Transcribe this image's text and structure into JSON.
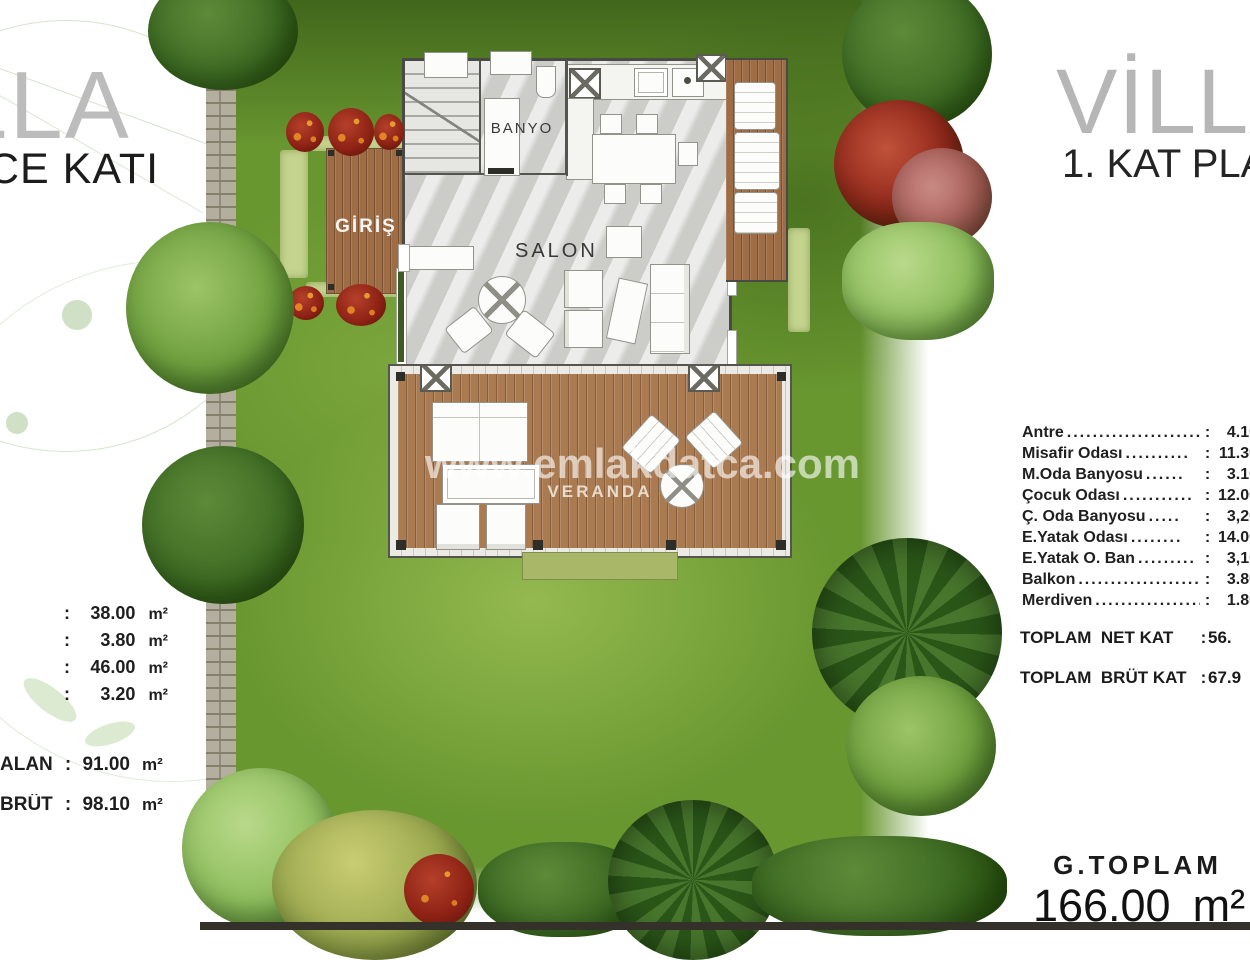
{
  "watermark": {
    "text": "www.emlakdatca.com"
  },
  "left_panel": {
    "title_partial": "LLA",
    "subtitle_partial": "CE KATI",
    "sep": ":",
    "measurements": [
      {
        "value": "38.00",
        "unit": "m²"
      },
      {
        "value": "3.80",
        "unit": "m²"
      },
      {
        "value": "46.00",
        "unit": "m²"
      },
      {
        "value": "3.20",
        "unit": "m²"
      }
    ],
    "totals": [
      {
        "label": "ALAN",
        "value": "91.00",
        "unit": "m²"
      },
      {
        "label": "BRÜT",
        "value": "98.10",
        "unit": "m²"
      }
    ]
  },
  "right_panel": {
    "title": "VİLLA",
    "subtitle": "1. KAT PLANI",
    "sep": ":",
    "rooms": [
      {
        "name": "Antre",
        "dots": "......................",
        "value": "4.10"
      },
      {
        "name": "Misafir Odası",
        "dots": "..........",
        "value": "11.30"
      },
      {
        "name": "M.Oda Banyosu",
        "dots": "......",
        "value": "3.10"
      },
      {
        "name": "Çocuk Odası",
        "dots": "...........",
        "value": "12.00"
      },
      {
        "name": "Ç. Oda Banyosu",
        "dots": ".....",
        "value": "3,20"
      },
      {
        "name": "E.Yatak Odası",
        "dots": "........",
        "value": "14.00"
      },
      {
        "name": "E.Yatak O. Ban",
        "dots": ".........",
        "value": "3,10"
      },
      {
        "name": "Balkon",
        "dots": "....................",
        "value": "3.80"
      },
      {
        "name": "Merdiven",
        "dots": "..................",
        "value": "1.80"
      }
    ],
    "totals": [
      {
        "label": "TOPLAM  NET KAT",
        "value": "56."
      },
      {
        "label": "TOPLAM  BRÜT KAT",
        "value": "67.9"
      }
    ],
    "grand_total": {
      "label": "G.TOPLAM",
      "value": "166.00",
      "unit": "m²"
    }
  },
  "plan": {
    "labels": {
      "banyo": "BANYO",
      "salon": "SALON",
      "giris": "GİRİŞ",
      "veranda": "VERANDA"
    }
  },
  "colors": {
    "grass": "#68962f",
    "wood": "#aa7a51",
    "title_gray": "#b6b6b6",
    "text_dark": "#1e1e1e",
    "red_bush": "#8c2114",
    "watermark_white": "rgba(255,255,255,0.62)"
  }
}
